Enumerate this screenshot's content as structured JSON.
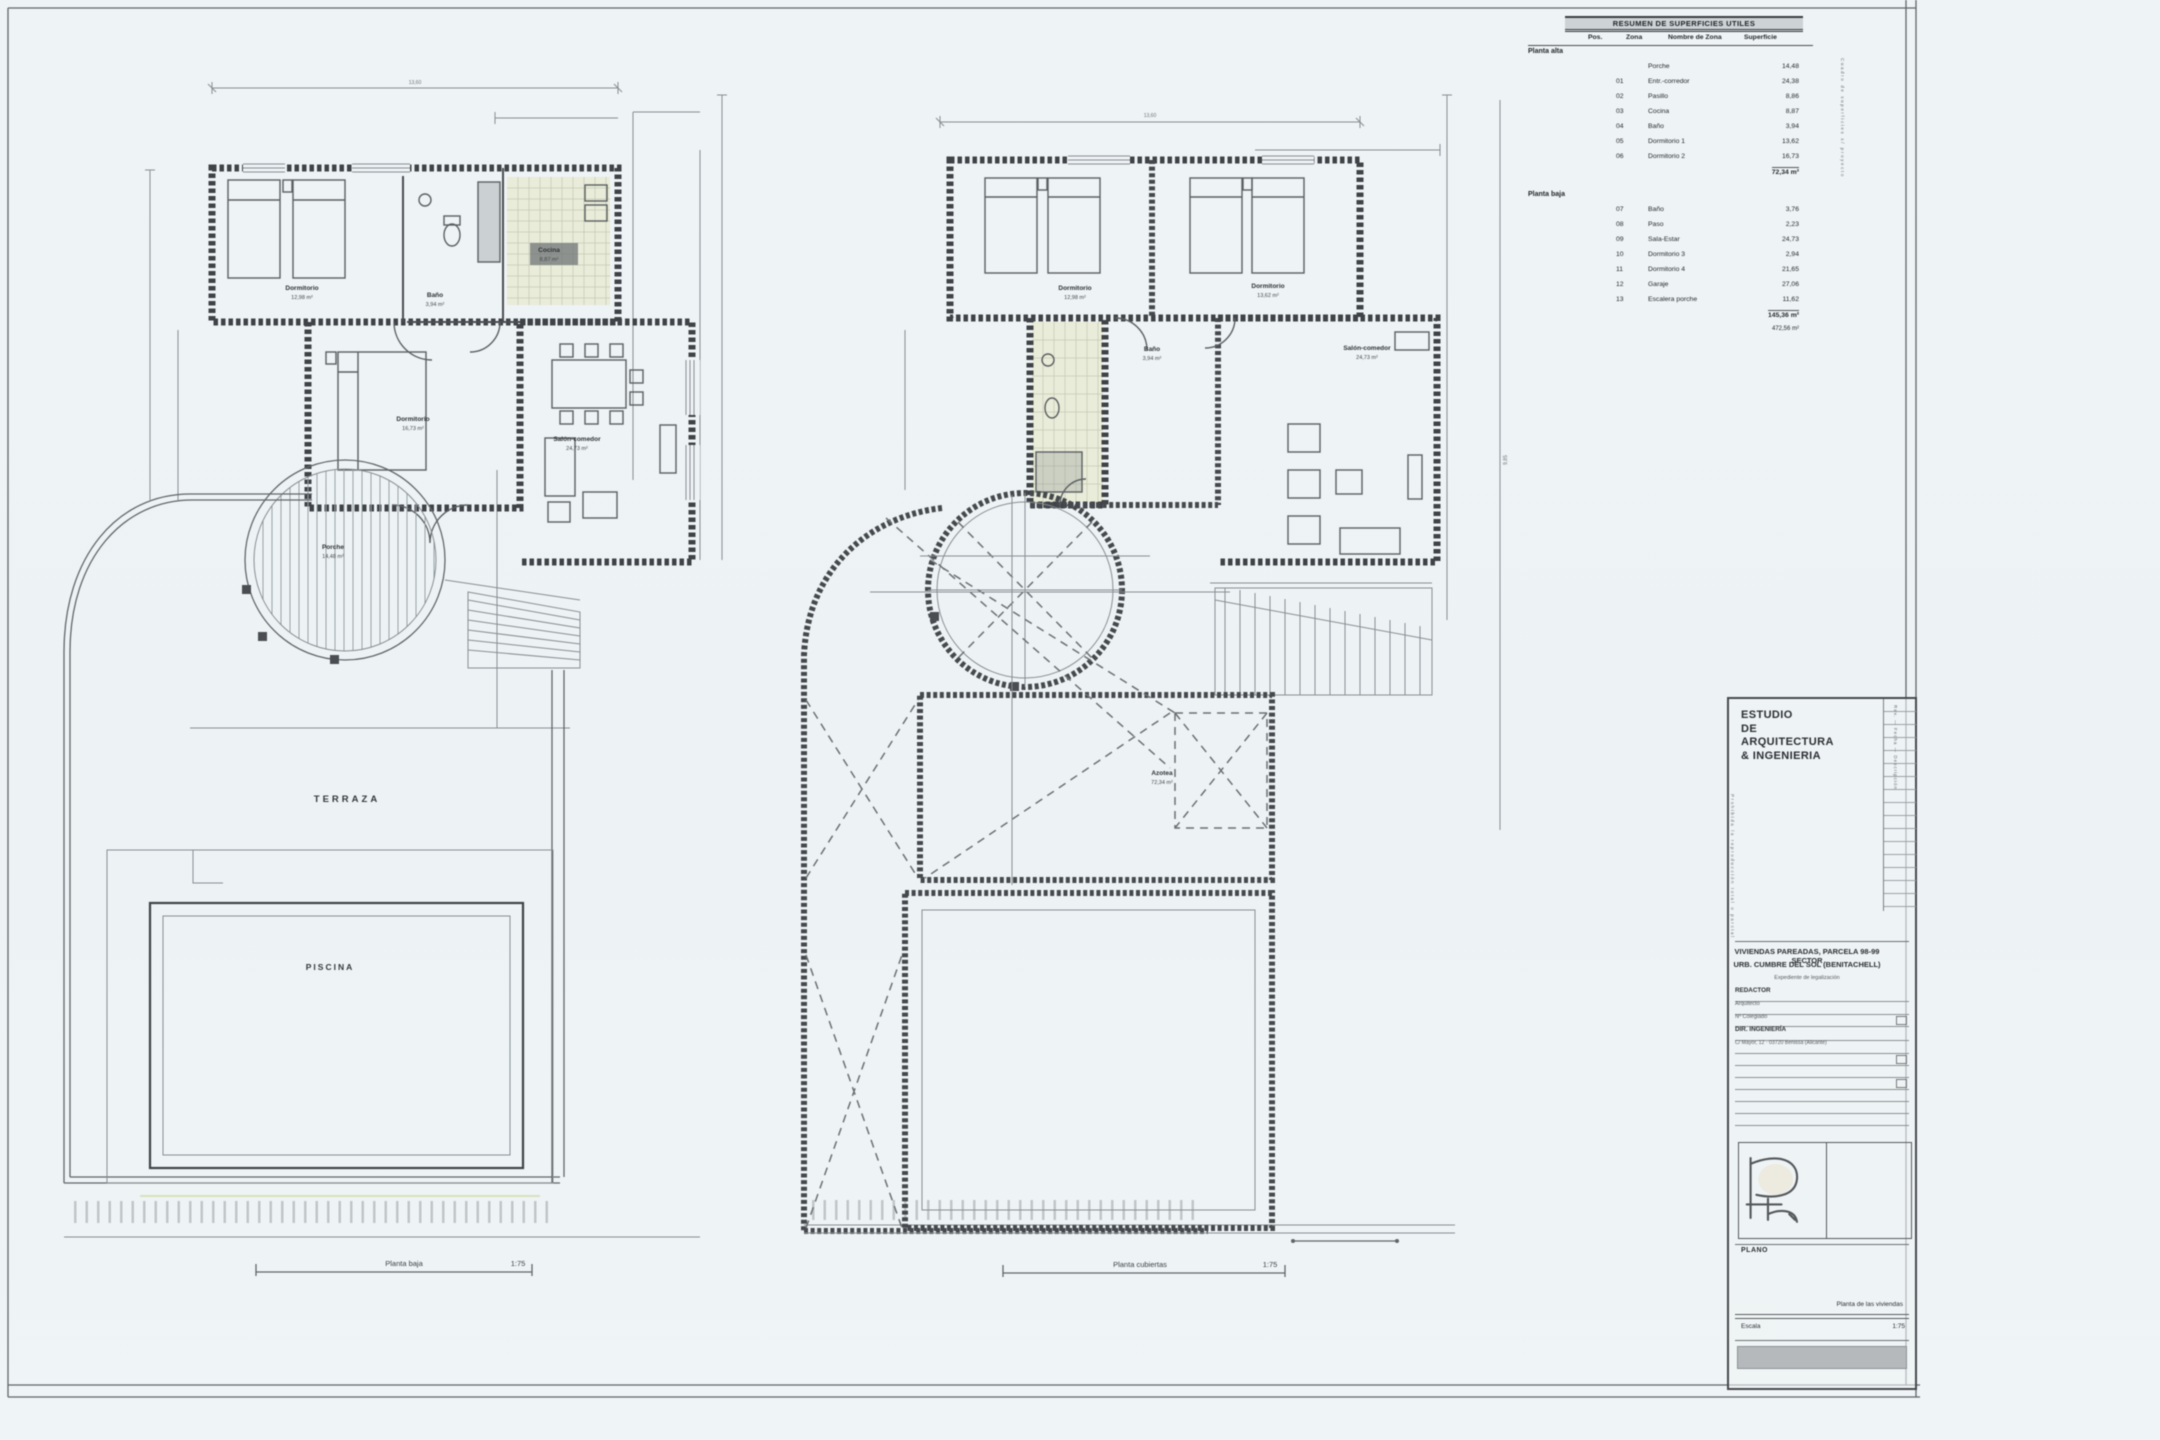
{
  "sheet": {
    "background": "#eef3f5",
    "line_color": "#3f4347",
    "accent_tint": "#e9ecd6"
  },
  "area_table": {
    "title": "RESUMEN DE SUPERFICIES UTILES",
    "headers": [
      "Pos.",
      "Zona",
      "Nombre de Zona",
      "Superficie"
    ],
    "side_note": "Cuadro de superficies s/ proyecto",
    "sections": [
      {
        "name": "Planta alta",
        "rows": [
          {
            "zona": "",
            "name": "Porche",
            "sup": "14,48"
          },
          {
            "zona": "01",
            "name": "Entr.-corredor",
            "sup": "24,38"
          },
          {
            "zona": "02",
            "name": "Pasillo",
            "sup": "8,86"
          },
          {
            "zona": "03",
            "name": "Cocina",
            "sup": "8,87"
          },
          {
            "zona": "04",
            "name": "Baño",
            "sup": "3,94"
          },
          {
            "zona": "05",
            "name": "Dormitorio 1",
            "sup": "13,62"
          },
          {
            "zona": "06",
            "name": "Dormitorio 2",
            "sup": "16,73"
          }
        ],
        "subtotal": "72,34 m²"
      },
      {
        "name": "Planta baja",
        "rows": [
          {
            "zona": "07",
            "name": "Baño",
            "sup": "3,76"
          },
          {
            "zona": "08",
            "name": "Paso",
            "sup": "2,23"
          },
          {
            "zona": "09",
            "name": "Sala-Estar",
            "sup": "24,73"
          },
          {
            "zona": "10",
            "name": "Dormitorio 3",
            "sup": "2,94"
          },
          {
            "zona": "11",
            "name": "Dormitorio 4",
            "sup": "21,65"
          },
          {
            "zona": "12",
            "name": "Garaje",
            "sup": "27,06"
          },
          {
            "zona": "13",
            "name": "Escalera porche",
            "sup": "11,62"
          }
        ],
        "total": "145,36 m²",
        "total2": "472,56 m²"
      }
    ]
  },
  "plans": {
    "left": {
      "caption": "Planta baja",
      "scale": "1:75",
      "dim_top": "13,60",
      "labels": {
        "dorm_up": {
          "l1": "Dormitorio",
          "l2": "12,98 m²"
        },
        "bano": {
          "l1": "Baño",
          "l2": "3,94 m²"
        },
        "cocina": {
          "l1": "Cocina",
          "l2": "8,87 m²"
        },
        "dorm_low": {
          "l1": "Dormitorio",
          "l2": "16,73 m²"
        },
        "salon": {
          "l1": "Salón-comedor",
          "l2": "24,73 m²"
        },
        "porche": {
          "l1": "Porche",
          "l2": "14,48 m²"
        },
        "terraza": "TERRAZA",
        "piscina": "PISCINA"
      }
    },
    "right": {
      "caption": "Planta cubiertas",
      "scale": "1:75",
      "dim_top": "13,60",
      "dim_side": "9,85",
      "labels": {
        "dorm1": {
          "l1": "Dormitorio",
          "l2": "12,98 m²"
        },
        "dorm2": {
          "l1": "Dormitorio",
          "l2": "13,62 m²"
        },
        "bano": {
          "l1": "Baño",
          "l2": "3,94 m²"
        },
        "salon": {
          "l1": "Salón-comedor",
          "l2": "24,73 m²"
        },
        "azotea": {
          "l1": "Azotea",
          "l2": "72,34 m²"
        }
      }
    }
  },
  "title_block": {
    "studio": [
      "ESTUDIO",
      "DE",
      "ARQUITECTURA",
      "& INGENIERIA"
    ],
    "side_left": "Prohibida la reproducción total o parcial",
    "side_right": "Rev. — Fecha — Descripción",
    "project_line1": "VIVIENDAS PAREADAS, PARCELA 98-99 SECTOR",
    "project_line2": "URB. CUMBRE DEL SOL (BENITACHELL)",
    "project_line3": "Expediente de legalización",
    "fields": {
      "redactor_label": "REDACTOR",
      "redactor_value": "Arquitecto",
      "colegiado": "Nº Colegiado",
      "direccion_label": "DIR. INGENIERÍA",
      "direccion_value": "C/ Mayor, 12 · 03720 Benissa (Alicante)"
    },
    "plano_label": "PLANO",
    "drawing_name": "Planta de las viviendas",
    "escala_label": "Escala",
    "escala_value": "1:75"
  }
}
